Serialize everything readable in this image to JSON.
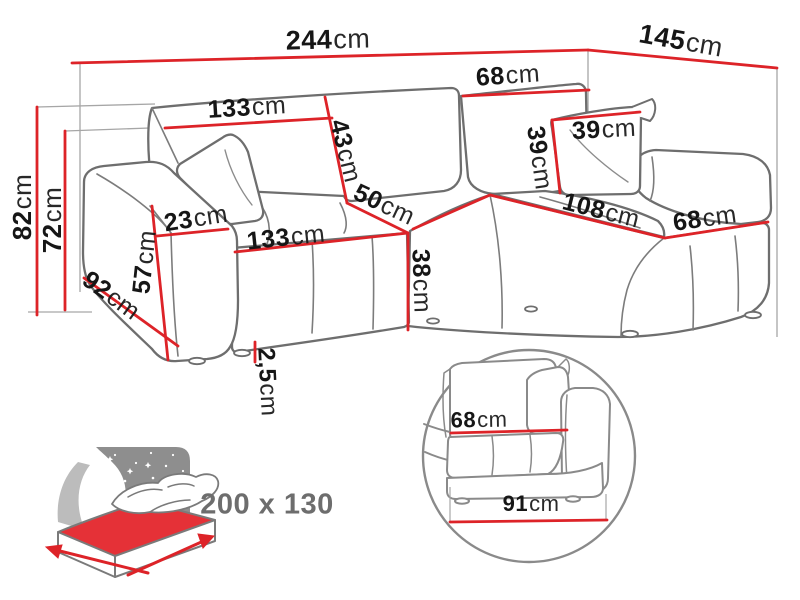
{
  "colors": {
    "dimension_red": "#dd2328",
    "outline_gray": "#6e6e6e",
    "detail_gray": "#8a8a8a",
    "extension_gray": "#a6a6a6",
    "label_black": "#161616",
    "icon_sky_gray": "#8e8e8e",
    "icon_crescent_gray": "#bcbcbc",
    "mattress_red": "#e53137",
    "icon_text_gray": "#6d6d6d"
  },
  "labels": [
    {
      "id": "dim-overall-width",
      "value": "244",
      "unit": "cm",
      "x": 328,
      "y": 40,
      "rot": -1.5,
      "size": 27
    },
    {
      "id": "dim-overall-depth",
      "value": "145",
      "unit": "cm",
      "x": 681,
      "y": 41,
      "rot": 10,
      "size": 27
    },
    {
      "id": "dim-total-height",
      "value": "82",
      "unit": "cm",
      "x": 22,
      "y": 207,
      "rot": -90,
      "size": 26
    },
    {
      "id": "dim-backrest-height-overall",
      "value": "72",
      "unit": "cm",
      "x": 52,
      "y": 220,
      "rot": -90,
      "size": 26
    },
    {
      "id": "dim-backrest-width-left",
      "value": "133",
      "unit": "cm",
      "x": 247,
      "y": 108,
      "rot": -3.5,
      "size": 25
    },
    {
      "id": "dim-backrest-face-height",
      "value": "43",
      "unit": "cm",
      "x": 345,
      "y": 151,
      "rot": 76,
      "size": 25
    },
    {
      "id": "dim-backrest-width-right",
      "value": "68",
      "unit": "cm",
      "x": 508,
      "y": 76,
      "rot": -4,
      "size": 25
    },
    {
      "id": "dim-cushion-width",
      "value": "39",
      "unit": "cm",
      "x": 604,
      "y": 130,
      "rot": -3,
      "size": 25
    },
    {
      "id": "dim-cushion-height",
      "value": "39",
      "unit": "cm",
      "x": 539,
      "y": 158,
      "rot": 82,
      "size": 25
    },
    {
      "id": "dim-armrest-top-width",
      "value": "23",
      "unit": "cm",
      "x": 196,
      "y": 219,
      "rot": -9,
      "size": 25
    },
    {
      "id": "dim-seat-width",
      "value": "133",
      "unit": "cm",
      "x": 286,
      "y": 238,
      "rot": -6,
      "size": 25
    },
    {
      "id": "dim-seat-depth-split",
      "value": "50",
      "unit": "cm",
      "x": 384,
      "y": 205,
      "rot": 25,
      "size": 25
    },
    {
      "id": "dim-seat-height",
      "value": "38",
      "unit": "cm",
      "x": 421,
      "y": 281,
      "rot": 88,
      "size": 25
    },
    {
      "id": "dim-chaise-length",
      "value": "108",
      "unit": "cm",
      "x": 601,
      "y": 211,
      "rot": 14,
      "size": 25
    },
    {
      "id": "dim-chaise-width",
      "value": "68",
      "unit": "cm",
      "x": 705,
      "y": 219,
      "rot": -8,
      "size": 25
    },
    {
      "id": "dim-armrest-height",
      "value": "57",
      "unit": "cm",
      "x": 145,
      "y": 262,
      "rot": -84,
      "size": 25
    },
    {
      "id": "dim-armrest-depth",
      "value": "92",
      "unit": "cm",
      "x": 111,
      "y": 296,
      "rot": 36,
      "size": 25
    },
    {
      "id": "dim-leg-height",
      "value": "2,5",
      "unit": "cm",
      "x": 267,
      "y": 382,
      "rot": 87,
      "size": 24
    },
    {
      "id": "inset-seat-depth",
      "value": "68",
      "unit": "cm",
      "x": 479,
      "y": 420,
      "rot": -1,
      "size": 22
    },
    {
      "id": "inset-total-depth",
      "value": "91",
      "unit": "cm",
      "x": 531,
      "y": 504,
      "rot": 0,
      "size": 22
    },
    {
      "id": "bed-size",
      "value": "200 x 130",
      "unit": "",
      "x": 267,
      "y": 505,
      "rot": 0,
      "size": 29,
      "color": "#6d6d6d"
    }
  ]
}
